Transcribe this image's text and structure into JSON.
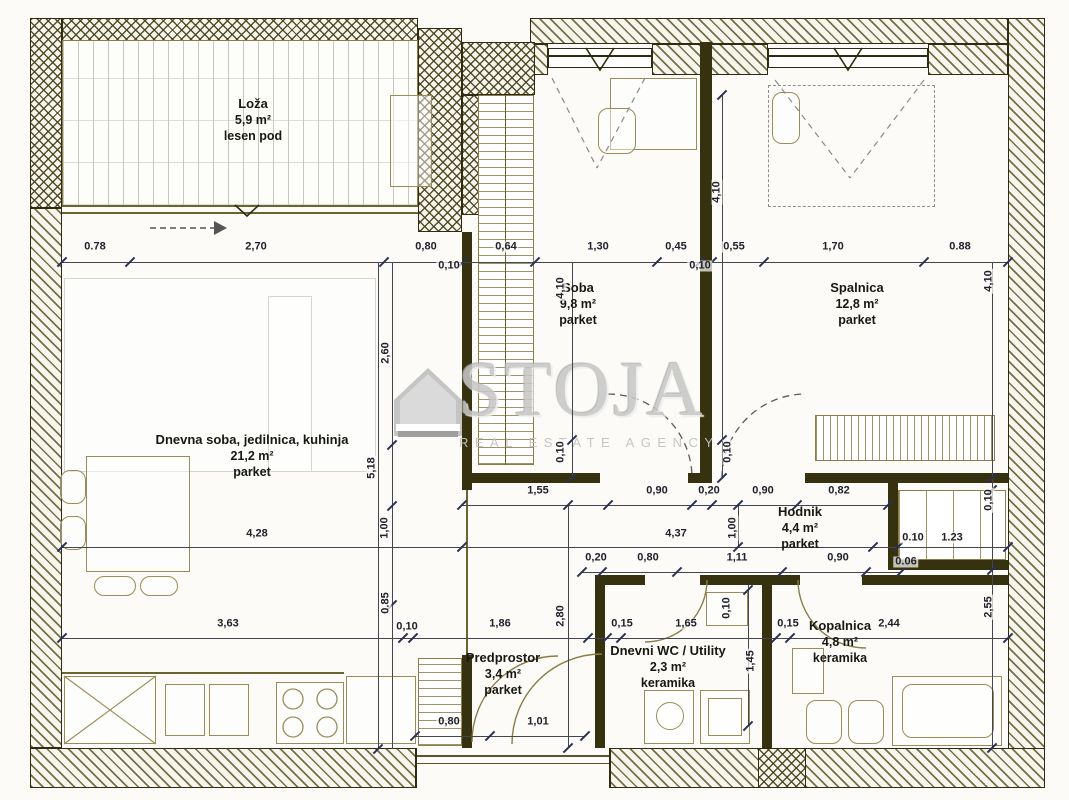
{
  "watermark": {
    "brand": "STOJA",
    "tagline": "REAL ESTATE AGENCY"
  },
  "rooms": [
    {
      "id": "loza",
      "name": "Loža",
      "area": "5,9 m²",
      "floor": "lesen pod",
      "x": 253,
      "y": 96
    },
    {
      "id": "dnevna-soba",
      "name": "Dnevna soba, jedilnica, kuhinja",
      "area": "21,2 m²",
      "floor": "parket",
      "x": 252,
      "y": 432
    },
    {
      "id": "soba",
      "name": "Soba",
      "area": "9,8 m²",
      "floor": "parket",
      "x": 578,
      "y": 280
    },
    {
      "id": "spalnica",
      "name": "Spalnica",
      "area": "12,8 m²",
      "floor": "parket",
      "x": 857,
      "y": 280
    },
    {
      "id": "hodnik",
      "name": "Hodnik",
      "area": "4,4 m²",
      "floor": "parket",
      "x": 800,
      "y": 504
    },
    {
      "id": "predprostor",
      "name": "Predprostor",
      "area": "3,4 m²",
      "floor": "parket",
      "x": 503,
      "y": 650
    },
    {
      "id": "dnevni-wc-utility",
      "name": "Dnevni WC / Utility",
      "area": "2,3 m²",
      "floor": "keramika",
      "x": 668,
      "y": 643
    },
    {
      "id": "kopalnica",
      "name": "Kopalnica",
      "area": "4,8 m²",
      "floor": "keramika",
      "x": 840,
      "y": 618
    }
  ],
  "dim_labels": [
    {
      "t": "0.78",
      "x": 95,
      "y": 247
    },
    {
      "t": "2,70",
      "x": 256,
      "y": 247
    },
    {
      "t": "0,80",
      "x": 426,
      "y": 247
    },
    {
      "t": "0,10",
      "x": 449,
      "y": 266
    },
    {
      "t": "0,64",
      "x": 506,
      "y": 247
    },
    {
      "t": "1,30",
      "x": 598,
      "y": 247
    },
    {
      "t": "0,45",
      "x": 676,
      "y": 247
    },
    {
      "t": "0,55",
      "x": 734,
      "y": 247
    },
    {
      "t": "0,10",
      "x": 700,
      "y": 266
    },
    {
      "t": "1,70",
      "x": 833,
      "y": 247
    },
    {
      "t": "0.88",
      "x": 960,
      "y": 247
    },
    {
      "t": "4,10",
      "x": 561,
      "y": 288,
      "r": 1
    },
    {
      "t": "4,10",
      "x": 717,
      "y": 192,
      "r": 1
    },
    {
      "t": "4,10",
      "x": 989,
      "y": 281,
      "r": 1
    },
    {
      "t": "0,10",
      "x": 561,
      "y": 452,
      "r": 1
    },
    {
      "t": "0,10",
      "x": 728,
      "y": 452,
      "r": 1
    },
    {
      "t": "0,10",
      "x": 989,
      "y": 500,
      "r": 1
    },
    {
      "t": "1,55",
      "x": 538,
      "y": 491
    },
    {
      "t": "0,90",
      "x": 657,
      "y": 491
    },
    {
      "t": "0,20",
      "x": 709,
      "y": 491
    },
    {
      "t": "0,90",
      "x": 763,
      "y": 491
    },
    {
      "t": "0,82",
      "x": 839,
      "y": 491
    },
    {
      "t": "4,28",
      "x": 257,
      "y": 534
    },
    {
      "t": "4,37",
      "x": 676,
      "y": 534
    },
    {
      "t": "1,00",
      "x": 385,
      "y": 528,
      "r": 1
    },
    {
      "t": "1,00",
      "x": 733,
      "y": 528,
      "r": 1
    },
    {
      "t": "0.10",
      "x": 913,
      "y": 538
    },
    {
      "t": "1.23",
      "x": 952,
      "y": 538
    },
    {
      "t": "0,20",
      "x": 596,
      "y": 558
    },
    {
      "t": "0,80",
      "x": 648,
      "y": 558
    },
    {
      "t": "1,11",
      "x": 737,
      "y": 558
    },
    {
      "t": "0,90",
      "x": 838,
      "y": 558
    },
    {
      "t": "0.06",
      "x": 906,
      "y": 562
    },
    {
      "t": "2,60",
      "x": 386,
      "y": 353,
      "r": 1
    },
    {
      "t": "5,18",
      "x": 372,
      "y": 468,
      "r": 1
    },
    {
      "t": "0.85",
      "x": 386,
      "y": 603,
      "r": 1
    },
    {
      "t": "2,80",
      "x": 561,
      "y": 616,
      "r": 1
    },
    {
      "t": "3,63",
      "x": 228,
      "y": 624
    },
    {
      "t": "0,10",
      "x": 407,
      "y": 627
    },
    {
      "t": "1,86",
      "x": 500,
      "y": 624
    },
    {
      "t": "0,15",
      "x": 622,
      "y": 624
    },
    {
      "t": "1,65",
      "x": 686,
      "y": 624
    },
    {
      "t": "0,10",
      "x": 727,
      "y": 608,
      "r": 1
    },
    {
      "t": "0,15",
      "x": 788,
      "y": 624
    },
    {
      "t": "2,44",
      "x": 889,
      "y": 624
    },
    {
      "t": "1,45",
      "x": 751,
      "y": 661,
      "r": 1
    },
    {
      "t": "2,55",
      "x": 989,
      "y": 607,
      "r": 1
    },
    {
      "t": "0,80",
      "x": 449,
      "y": 722
    },
    {
      "t": "1,01",
      "x": 538,
      "y": 722
    }
  ]
}
